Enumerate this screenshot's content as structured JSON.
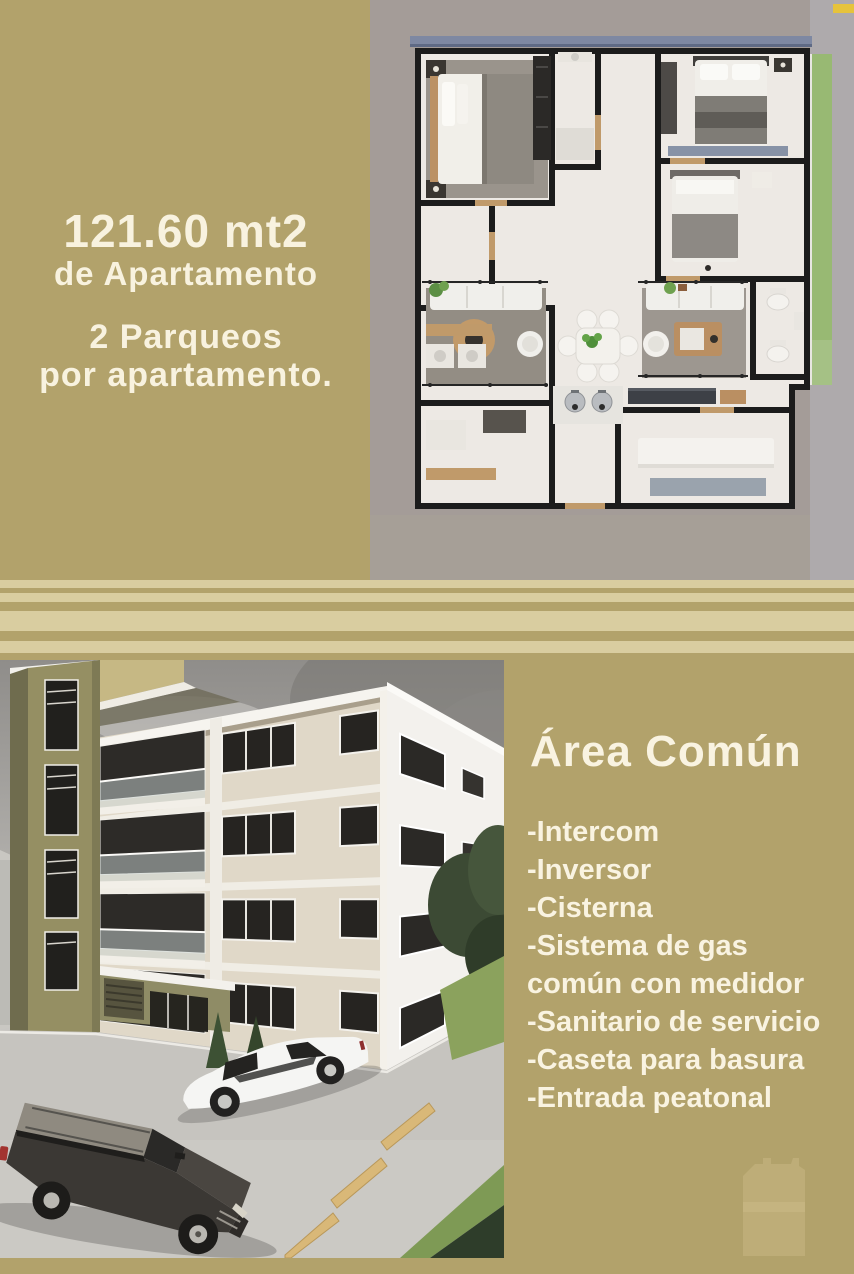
{
  "colors": {
    "background": "#b2a26b",
    "stripe_light": "#d9cda0",
    "text": "#f8f2df",
    "plan_backdrop": "#a49c98",
    "yellow_tag": "#e6c33c"
  },
  "top_section": {
    "area_size": "121.60 mt2",
    "area_caption": "de Apartamento",
    "parking_line1": "2 Parqueos",
    "parking_line2": "por apartamento."
  },
  "amenities": {
    "title": "Área Común",
    "items": [
      "-Intercom",
      "-Inversor",
      "-Cisterna",
      "-Sistema de gas",
      "común con medidor",
      "-Sanitario de servicio",
      "-Caseta para basura",
      "-Entrada peatonal"
    ]
  }
}
